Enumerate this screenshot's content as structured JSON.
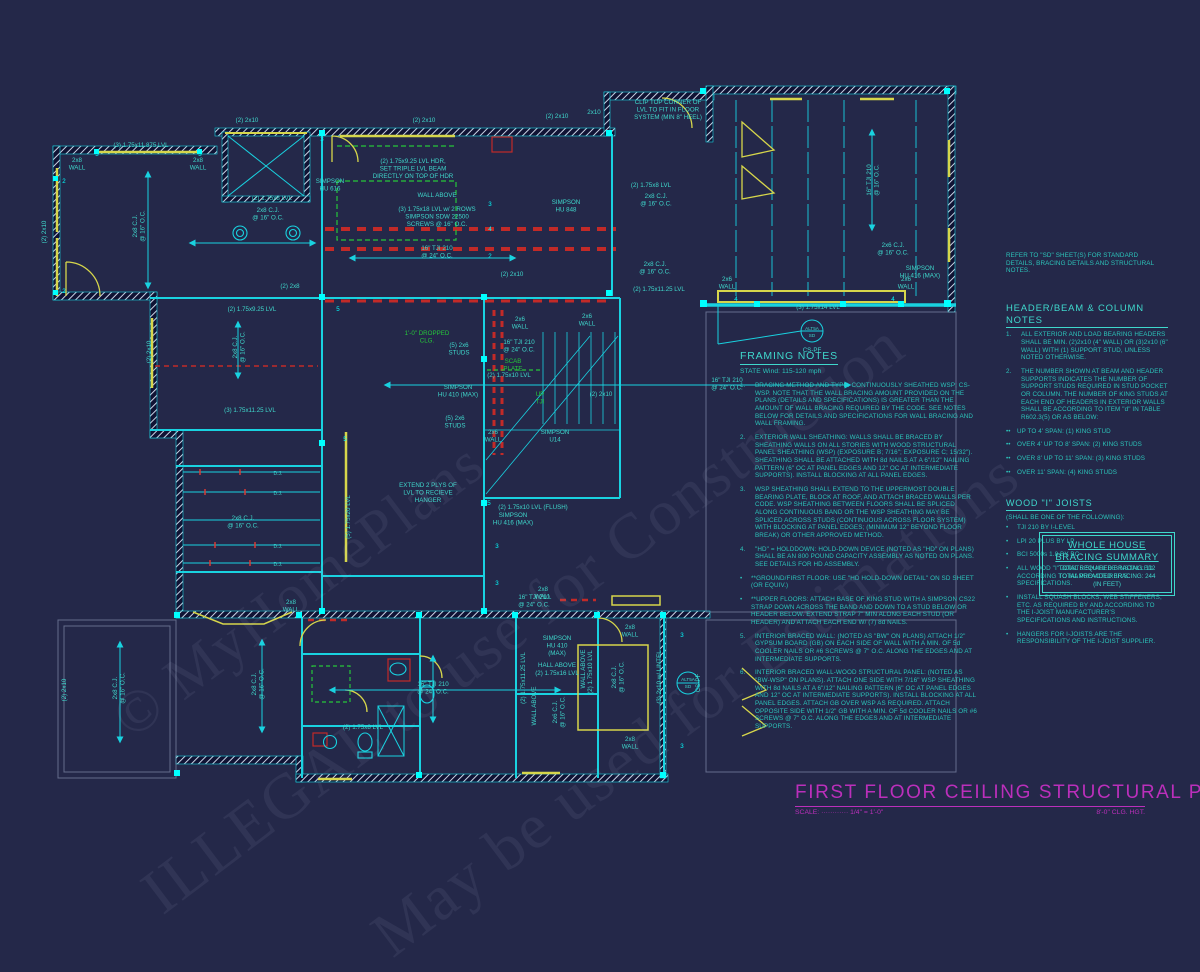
{
  "title_block": {
    "title": "FIRST FLOOR CEILING STRUCTURAL PLAN",
    "scale_label": "SCALE: ············ 1/4\" = 1'-0\"",
    "ceiling_height": "8'-0\" CLG. HGT."
  },
  "watermarks": {
    "line1": "© MyHomePlans",
    "line2": "ILLEGAL to use for Construction",
    "line3": "May be used for Estimations"
  },
  "colors": {
    "background": "#242849",
    "wall_cyan": "#19d2e0",
    "label_teal": "#3fd8cc",
    "notes_teal": "#2cc4ba",
    "bright_cyan": "#00ffff",
    "beam_yellow": "#d6d64b",
    "braced_red": "#d63a34",
    "dropped_green": "#26c63a",
    "title_magenta": "#bb2fbb"
  },
  "framing_notes": {
    "heading": "FRAMING NOTES",
    "subheading": "STATE Wind: 115-120 mph",
    "items": [
      {
        "num": "1.",
        "text": "BRACING METHOD AND TYPE: CONTINUOUSLY SHEATHED WSP; CS-WSP. NOTE THAT THE WALL BRACING AMOUNT PROVIDED ON THE PLANS (DETAILS AND SPECIFICATIONS) IS GREATER THAN THE AMOUNT OF WALL BRACING REQUIRED BY THE CODE. SEE NOTES BELOW FOR DETAILS AND SPECIFICATIONS FOR WALL BRACING AND WALL FRAMING."
      },
      {
        "num": "2.",
        "text": "EXTERIOR WALL SHEATHING: WALLS SHALL BE BRACED BY SHEATHING WALLS ON ALL STORIES WITH WOOD STRUCTURAL PANEL SHEATHING (WSP) (EXPOSURE B; 7/16\"; EXPOSURE C; 15/32\"). SHEATHING SHALL BE ATTACHED WITH 8d NAILS AT A 6\"/12\" NAILING PATTERN (6\" OC AT PANEL EDGES AND 12\" OC AT INTERMEDIATE SUPPORTS). INSTALL BLOCKING AT ALL PANEL EDGES."
      },
      {
        "num": "3.",
        "text": "WSP SHEATHING SHALL EXTEND TO THE UPPERMOST DOUBLE BEARING PLATE, BLOCK AT ROOF, AND ATTACH BRACED WALLS PER CODE. WSP SHEATHING BETWEEN FLOORS SHALL BE SPLICED ALONG CONTINUOUS BAND OR THE WSP SHEATHING MAY BE SPLICED ACROSS STUDS (CONTINUOUS ACROSS FLOOR SYSTEM) WITH BLOCKING AT PANEL EDGES; (MINIMUM 12\" BEYOND FLOOR BREAK) OR OTHER APPROVED METHOD."
      },
      {
        "num": "4.",
        "text": "\"HD\" = HOLDDOWN: HOLD-DOWN DEVICE (NOTED AS \"HD\" ON PLANS) SHALL BE AN 800 POUND CAPACITY ASSEMBLY AS NOTED ON PLANS. SEE DETAILS FOR HD ASSEMBLY.",
        "bullets": [
          "**GROUND/FIRST FLOOR: USE \"HD HOLD-DOWN DETAIL\" ON SD SHEET (OR EQUIV.)",
          "**UPPER FLOORS: ATTACH BASE OF KING STUD WITH A SIMPSON CS22 STRAP DOWN ACROSS THE BAND AND DOWN TO A STUD BELOW OR HEADER BELOW. EXTEND STRAP 7\" MIN ALONG EACH STUD (OR HEADER) AND ATTACH EACH END W/ (7) 8d NAILS."
        ]
      },
      {
        "num": "5.",
        "text": "INTERIOR BRACED WALL: (NOTED AS \"BW\" ON PLANS) ATTACH 1/2\" GYPSUM BOARD (GB) ON EACH SIDE OF WALL WITH A MIN. OF 5d COOLER NAILS OR #6 SCREWS @ 7\" O.C. ALONG THE EDGES AND AT INTERMEDIATE SUPPORTS."
      },
      {
        "num": "6.",
        "text": "INTERIOR BRACED WALL-WOOD STRUCTURAL PANEL: (NOTED AS \"BW-WSP\" ON PLANS). ATTACH ONE SIDE WITH 7/16\" WSP SHEATHING WITH 8d NAILS AT A 6\"/12\" NAILING PATTERN (6\" OC AT PANEL EDGES AND 12\" OC AT INTERMEDIATE SUPPORTS). INSTALL BLOCKING AT ALL PANEL EDGES. ATTACH GB OVER WSP AS REQUIRED. ATTACH OPPOSITE SIDE WITH 1/2\" GB WITH A MIN. OF 5d COOLER NAILS OR #6 SCREWS @ 7\" O.C. ALONG THE EDGES AND AT INTERMEDIATE SUPPORTS."
      }
    ]
  },
  "side_notes": {
    "refer": "REFER TO \"SD\" SHEET(S) FOR STANDARD DETAILS, BRACING DETAILS AND STRUCTURAL NOTES.",
    "header_beam": {
      "heading": "HEADER/BEAM & COLUMN NOTES",
      "items": [
        {
          "num": "1.",
          "text": "ALL EXTERIOR AND LOAD BEARING HEADERS SHALL BE MIN. (2)2x10 (4\" WALL) OR (3)2x10 (6\" WALL) WITH (1) SUPPORT STUD, UNLESS NOTED OTHERWISE."
        },
        {
          "num": "2.",
          "text": "THE NUMBER SHOWN AT BEAM AND HEADER SUPPORTS INDICATES THE NUMBER OF SUPPORT STUDS REQUIRED IN STUD POCKET OR COLUMN. THE NUMBER OF KING STUDS AT EACH END OF HEADERS IN EXTERIOR WALLS SHALL BE ACCORDING TO ITEM \"d\" IN TABLE R602.3(5) OR AS BELOW:"
        }
      ],
      "spans": [
        "UP TO 4' SPAN: (1) KING STUD",
        "OVER 4' UP TO 8' SPAN: (2) KING STUDS",
        "OVER 8' UP TO 11' SPAN: (3) KING STUDS",
        "OVER 11' SPAN: (4) KING STUDS"
      ]
    },
    "wood_joists": {
      "heading": "WOOD \"I\" JOISTS",
      "subheading": "(SHALL BE ONE OF THE FOLLOWING):",
      "brands": [
        "TJI 210 BY I-LEVEL",
        "LPI 20 PLUS BY LP",
        "BCI 5000s 1.8 BY BC"
      ],
      "bullets": [
        "ALL WOOD \"I\" JOISTS SHALL BE INSTALLED ACCORDING TO MANUFACTURER'S SPECIFICATIONS.",
        "INSTALL SQUASH BLOCKS, WEB STIFFENERS, ETC. AS REQUIRED BY AND ACCORDING TO THE I-JOIST MANUFACTURER'S SPECIFICATIONS AND INSTRUCTIONS.",
        "HANGERS FOR I-JOISTS ARE THE RESPONSIBILITY OF THE I-JOIST SUPPLIER."
      ]
    },
    "bracing_summary": {
      "heading_line1": "WHOLE HOUSE",
      "heading_line2": "BRACING SUMMARY",
      "required": "TOTAL REQUIRED BRACING: 112",
      "provided": "TOTAL PROVIDED BRACING: 244",
      "unit": "(IN FEET)"
    }
  },
  "plan": {
    "labels": [
      {
        "t": "(3) 1.75x11.875 LVL",
        "x": 141,
        "y": 147
      },
      {
        "t": "3",
        "x": 97,
        "y": 156,
        "c": "bright"
      },
      {
        "t": "3",
        "x": 200,
        "y": 156,
        "c": "bright"
      },
      {
        "t": "2x8\nWALL",
        "x": 77,
        "y": 162
      },
      {
        "t": "2x8\nWALL",
        "x": 198,
        "y": 162
      },
      {
        "t": "(2) 2x10",
        "x": 46,
        "y": 232,
        "r": -90
      },
      {
        "t": "2",
        "x": 64,
        "y": 183,
        "c": "bright"
      },
      {
        "t": "2",
        "x": 64,
        "y": 293,
        "c": "bright"
      },
      {
        "t": "2x8 C.J.\n@ 16\" O.C.",
        "x": 137,
        "y": 226,
        "r": -90
      },
      {
        "t": "(2) 2x10",
        "x": 247,
        "y": 122
      },
      {
        "t": "(2) 1.75x8 LVL",
        "x": 272,
        "y": 200
      },
      {
        "t": "2x8 C.J.\n@ 16\" O.C.",
        "x": 268,
        "y": 212
      },
      {
        "t": "(2) 2x10",
        "x": 424,
        "y": 122
      },
      {
        "t": "(2) 2x10",
        "x": 557,
        "y": 118
      },
      {
        "t": "2x10",
        "x": 594,
        "y": 114
      },
      {
        "t": "CLIP TOP CORNER OF\nLVL TO FIT IN FLOOR\nSYSTEM (MIN 8\" HEEL)",
        "x": 668,
        "y": 104
      },
      {
        "t": "SIMPSON\nHU 616",
        "x": 330,
        "y": 183
      },
      {
        "t": "(2) 1.75x9.25 LVL HDR,\nSET TRIPLE LVL BEAM\nDIRECTLY ON TOP OF HDR",
        "x": 413,
        "y": 163
      },
      {
        "t": "WALL ABOVE",
        "x": 437,
        "y": 197
      },
      {
        "t": "(3) 1.75x18 LVL w/ 2 ROWS\nSIMPSON SDW 22500\nSCREWS @ 16\" O.C.",
        "x": 437,
        "y": 211
      },
      {
        "t": "SIMPSON\nHU 848",
        "x": 566,
        "y": 204
      },
      {
        "t": "(2) 1.75x8 LVL",
        "x": 651,
        "y": 187
      },
      {
        "t": "2x8 C.J.\n@ 16\" O.C.",
        "x": 656,
        "y": 198
      },
      {
        "t": "3",
        "x": 322,
        "y": 141,
        "c": "bright"
      },
      {
        "t": "3",
        "x": 490,
        "y": 206,
        "c": "bright"
      },
      {
        "t": "4",
        "x": 490,
        "y": 231,
        "c": "bright"
      },
      {
        "t": "2",
        "x": 490,
        "y": 258,
        "c": "bright"
      },
      {
        "t": "16\" TJI 210\n@ 24\" O.C.",
        "x": 437,
        "y": 250
      },
      {
        "t": "(2) 2x10",
        "x": 512,
        "y": 276
      },
      {
        "t": "(2) 1.75x11.25 LVL",
        "x": 659,
        "y": 291
      },
      {
        "t": "2x8 C.J.\n@ 16\" O.C.",
        "x": 655,
        "y": 266
      },
      {
        "t": "2x6 C.J.\n@ 16\" O.C.",
        "x": 893,
        "y": 247
      },
      {
        "t": "SIMPSON\nHU 416 (MAX)",
        "x": 920,
        "y": 270
      },
      {
        "t": "16\" TJI 210\n@ 16\" O.C.",
        "x": 871,
        "y": 180,
        "r": -90
      },
      {
        "t": "2x6\nWALL",
        "x": 727,
        "y": 281
      },
      {
        "t": "2x6\nWALL",
        "x": 906,
        "y": 281
      },
      {
        "t": "(3) 1.75x14 LVL",
        "x": 818,
        "y": 309
      },
      {
        "t": "4",
        "x": 736,
        "y": 301,
        "c": "bright"
      },
      {
        "t": "4",
        "x": 893,
        "y": 301,
        "c": "bright"
      },
      {
        "t": "ALT5A",
        "x": 812,
        "y": 330,
        "s": 4.6
      },
      {
        "t": "SD",
        "x": 812,
        "y": 337,
        "s": 4.6
      },
      {
        "t": "CS-PF",
        "x": 812,
        "y": 352
      },
      {
        "t": "(2) 2x8",
        "x": 290,
        "y": 288
      },
      {
        "t": "(2) 1.75x9.25 LVL",
        "x": 252,
        "y": 311
      },
      {
        "t": "5",
        "x": 338,
        "y": 311,
        "c": "bright"
      },
      {
        "t": "2x8 C.J.\n@ 16\" O.C.",
        "x": 237,
        "y": 347,
        "r": -90
      },
      {
        "t": "(2) 2x10",
        "x": 151,
        "y": 352,
        "r": -90
      },
      {
        "t": "(3) 1.75x11.25 LVL",
        "x": 250,
        "y": 412
      },
      {
        "t": "1'-0\" DROPPED\nCLG.",
        "x": 427,
        "y": 335,
        "c": "green"
      },
      {
        "t": "(5) 2x6\nSTUDS",
        "x": 459,
        "y": 347
      },
      {
        "t": "2x6\nWALL",
        "x": 520,
        "y": 321
      },
      {
        "t": "16\" TJI 210\n@ 24\" O.C.",
        "x": 519,
        "y": 344
      },
      {
        "t": "SCAB\nPLATE",
        "x": 513,
        "y": 363,
        "c": "green"
      },
      {
        "t": "(2) 1.75x10 LVL",
        "x": 509,
        "y": 377
      },
      {
        "t": "UP\nTJI",
        "x": 540,
        "y": 396,
        "c": "green"
      },
      {
        "t": "SIMPSON\nHU 410 (MAX)",
        "x": 458,
        "y": 389
      },
      {
        "t": "(5) 2x6\nSTUDS",
        "x": 455,
        "y": 420
      },
      {
        "t": "2x6\nWALL",
        "x": 493,
        "y": 434
      },
      {
        "t": "2x6\nWALL",
        "x": 587,
        "y": 318
      },
      {
        "t": "(2) 2x10",
        "x": 601,
        "y": 396
      },
      {
        "t": "SIMPSON\nU14",
        "x": 555,
        "y": 434
      },
      {
        "t": "16\" TJI 210\n@ 24\" O.C.",
        "x": 727,
        "y": 382
      },
      {
        "t": "(5) 1.75x20 LVL",
        "x": 350,
        "y": 517,
        "r": -90
      },
      {
        "t": "5",
        "x": 345,
        "y": 441,
        "c": "bright"
      },
      {
        "t": "D.J.",
        "x": 278,
        "y": 475,
        "s": 5
      },
      {
        "t": "D.J.",
        "x": 278,
        "y": 495,
        "s": 5
      },
      {
        "t": "D.J.",
        "x": 278,
        "y": 548,
        "s": 5
      },
      {
        "t": "D.J.",
        "x": 278,
        "y": 566,
        "s": 5
      },
      {
        "t": "2x8 C.J.\n@ 16\" O.C.",
        "x": 243,
        "y": 520
      },
      {
        "t": "EXTEND 2 PLYS OF\nLVL TO RECIEVE\nHANGER",
        "x": 428,
        "y": 487
      },
      {
        "t": "(2) 1.75x10 LVL (FLUSH)",
        "x": 533,
        "y": 509
      },
      {
        "t": "SIMPSON\nHU 416 (MAX)",
        "x": 513,
        "y": 517
      },
      {
        "t": "5",
        "x": 489,
        "y": 505,
        "c": "bright"
      },
      {
        "t": "3",
        "x": 497,
        "y": 548,
        "c": "bright"
      },
      {
        "t": "3",
        "x": 497,
        "y": 585,
        "c": "bright"
      },
      {
        "t": "16\" TJI 210\n@ 24\" O.C.",
        "x": 534,
        "y": 599
      },
      {
        "t": "2x8\nWALL",
        "x": 291,
        "y": 604
      },
      {
        "t": "2x8\nWALL",
        "x": 543,
        "y": 591
      },
      {
        "t": "2x8 C.J.\n@ 16\" O.C.",
        "x": 256,
        "y": 684,
        "r": -90
      },
      {
        "t": "2x8 C.J.\n@ 16\" O.C.",
        "x": 117,
        "y": 688,
        "r": -90
      },
      {
        "t": "(2) 2x10",
        "x": 66,
        "y": 690,
        "r": -90
      },
      {
        "t": "16\" TJI 210\n@ 24\" O.C.",
        "x": 433,
        "y": 686
      },
      {
        "t": "(2) 1.75x8 LVL",
        "x": 363,
        "y": 729
      },
      {
        "t": "(2) 1.75x11.25 LVL",
        "x": 525,
        "y": 678,
        "r": -90
      },
      {
        "t": "WALL ABOVE",
        "x": 585,
        "y": 669,
        "r": -90
      },
      {
        "t": "(2) 1.75x10 LVL",
        "x": 592,
        "y": 672,
        "r": -90
      },
      {
        "t": "HALL ABOVE",
        "x": 557,
        "y": 667
      },
      {
        "t": "(2) 1.75x16 LVL",
        "x": 557,
        "y": 675
      },
      {
        "t": "SIMPSON\nHU 410\n(MAX)",
        "x": 557,
        "y": 640
      },
      {
        "t": "WALL ABOVE",
        "x": 536,
        "y": 706,
        "r": -90
      },
      {
        "t": "2x6 C.J.\n@ 16\" O.C.",
        "x": 557,
        "y": 712,
        "r": -90
      },
      {
        "t": "2x8 C.J.\n@ 16\" O.C.",
        "x": 616,
        "y": 677,
        "r": -90
      },
      {
        "t": "(3) 2x10 w/ LINTEL",
        "x": 661,
        "y": 677,
        "r": -90
      },
      {
        "t": "ALT5A",
        "x": 688,
        "y": 681,
        "s": 4.6
      },
      {
        "t": "SD",
        "x": 688,
        "y": 688,
        "s": 4.6
      },
      {
        "t": "CS-PF",
        "x": 700,
        "y": 683,
        "r": -90
      },
      {
        "t": "2x8\nWALL",
        "x": 630,
        "y": 629
      },
      {
        "t": "2x8\nWALL",
        "x": 630,
        "y": 741
      },
      {
        "t": "3",
        "x": 682,
        "y": 637,
        "c": "bright"
      },
      {
        "t": "3",
        "x": 682,
        "y": 748,
        "c": "bright"
      }
    ]
  }
}
